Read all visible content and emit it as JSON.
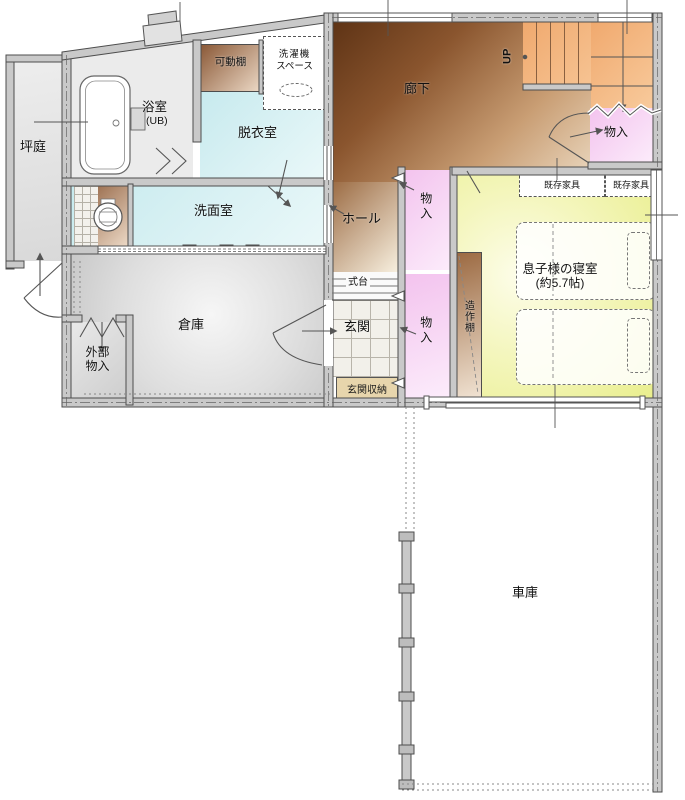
{
  "rooms": {
    "tsuboniwa": {
      "label": "坪庭"
    },
    "bath": {
      "label": "浴室",
      "sub": "(UB)"
    },
    "kadoudana": {
      "label": "可動棚"
    },
    "laundry": {
      "line1": "洗濯機",
      "line2": "スペース"
    },
    "datsuishitsu": {
      "label": "脱衣室"
    },
    "rouka": {
      "label": "廊下"
    },
    "stairs": {
      "label": "UP"
    },
    "mono_stairs": {
      "label": "物入"
    },
    "senmenshitsu": {
      "label": "洗面室"
    },
    "hall": {
      "label": "ホール"
    },
    "mono_hall": {
      "label": "物入"
    },
    "kizon_left": {
      "label": "既存家具"
    },
    "kizon_right": {
      "label": "既存家具"
    },
    "bedroom": {
      "label": "息子様の寝室",
      "sub": "(約5.7帖)"
    },
    "zousakudana": {
      "label": "造作棚"
    },
    "souko": {
      "label": "倉庫"
    },
    "gaibu": {
      "line1": "外部",
      "line2": "物入"
    },
    "shikidai": {
      "label": "式台"
    },
    "genkan": {
      "label": "玄関"
    },
    "mono_genkan": {
      "label": "物入"
    },
    "genkan_shuno": {
      "label": "玄関収納"
    },
    "shako": {
      "label": "車庫"
    }
  },
  "colors": {
    "wall_fill": "#c9c9c9",
    "wall_edge": "#4d4d4d",
    "water_room_cyan": "#d2eef1",
    "corridor_brown_dark": "#5e3315",
    "corridor_brown_light": "#f5ead7",
    "stairs_orange": "#f0a96e",
    "closet_pink": "#f3c3ee",
    "bedroom_yellow": "#eef193",
    "storage_gray": "#d9d9d9",
    "entrance_storage_tan": "#e7d5ac",
    "shelf_brown": "#9c6a42"
  }
}
